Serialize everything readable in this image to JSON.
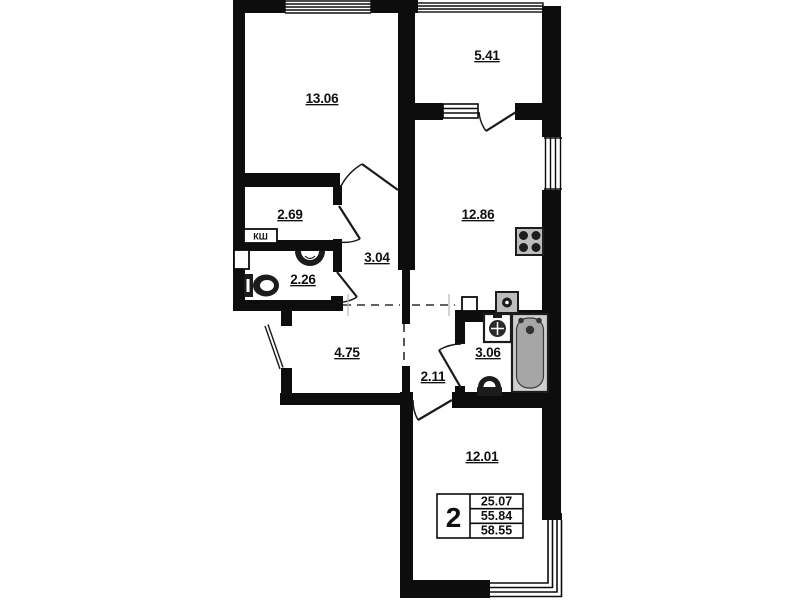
{
  "rooms": [
    {
      "name": "bedroom",
      "area": "13.06"
    },
    {
      "name": "balcony",
      "area": "5.41"
    },
    {
      "name": "kitchen",
      "area": "12.86"
    },
    {
      "name": "storage",
      "area": "2.69"
    },
    {
      "name": "hall",
      "area": "3.04"
    },
    {
      "name": "wc",
      "area": "2.26"
    },
    {
      "name": "hallway",
      "area": "4.75"
    },
    {
      "name": "corridor",
      "area": "2.11"
    },
    {
      "name": "bathroom",
      "area": "3.06"
    },
    {
      "name": "living_room",
      "area": "12.01"
    }
  ],
  "duct_label": "КШ",
  "stamp": {
    "rooms_count": "2",
    "living_area": "25.07",
    "apartment_area": "55.84",
    "total_area": "58.55"
  },
  "colors": {
    "wall": "#0d0d0d",
    "background": "#ffffff",
    "fixture_gray": "#bdbdbd",
    "tub_gray": "#a6a6a6",
    "text": "#101010"
  }
}
